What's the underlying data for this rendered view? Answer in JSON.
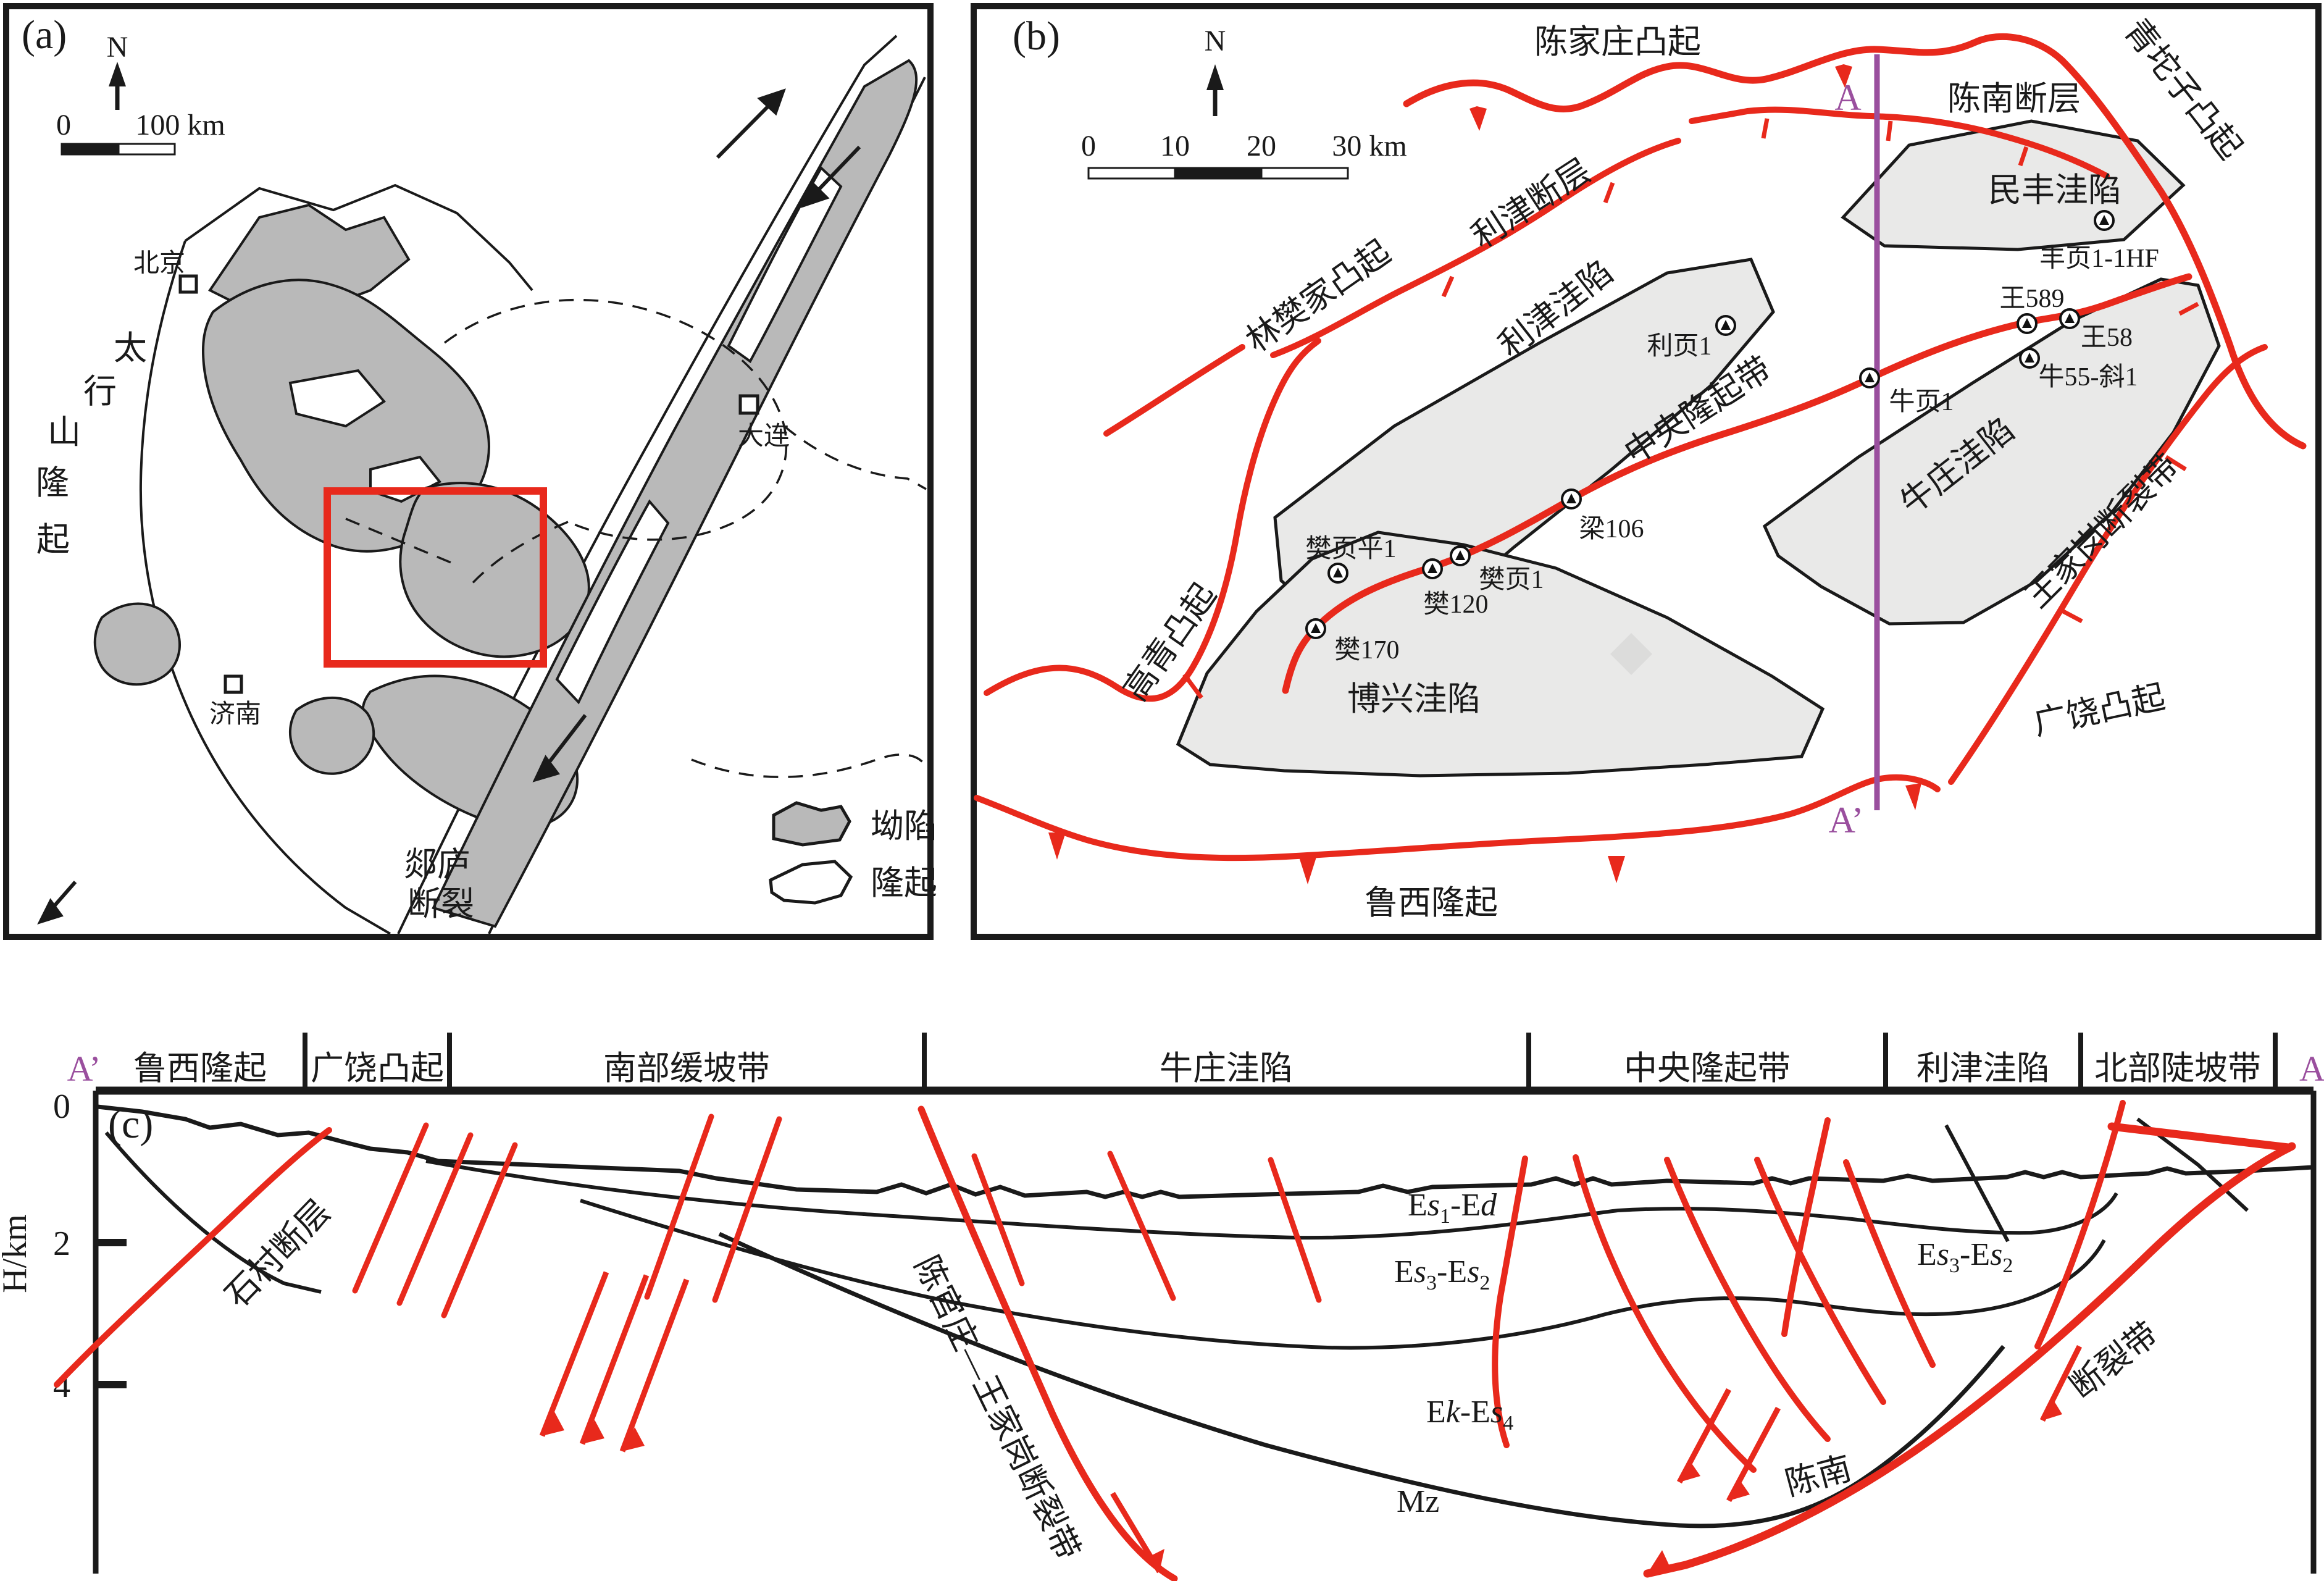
{
  "colors": {
    "fault_red": "#e8291c",
    "section_line_purple": "#9a4f9e",
    "regional_depression_gray": "#b9b9b9",
    "detail_depression_gray": "#e9e9e8"
  },
  "panel_a": {
    "tag": "(a)",
    "north": "N",
    "scale": {
      "zero": "0",
      "end": "100 km"
    },
    "cities": {
      "beijing": "北京",
      "jinan": "济南",
      "dalian": "大连"
    },
    "taihang": [
      "太",
      "行",
      "山",
      "隆",
      "起"
    ],
    "tanlu": [
      "郯庐",
      "断裂"
    ],
    "legend": {
      "depression": "坳陷",
      "uplift": "隆起"
    }
  },
  "panel_b": {
    "tag": "(b)",
    "north": "N",
    "scale": {
      "t0": "0",
      "t10": "10",
      "t20": "20",
      "t30": "30 km"
    },
    "labels": {
      "chenjiazhuang": "陈家庄凸起",
      "chennan_fault": "陈南断层",
      "qingtuozi": "青坨子凸起",
      "mifeng": "民丰洼陷",
      "lijin_fault": "利津断层",
      "linfanjia": "林樊家凸起",
      "lijin_sag": "利津洼陷",
      "central_uplift": "中央隆起带",
      "niuzhuang": "牛庄洼陷",
      "wangjiagang": "王家岗断裂带",
      "gaoqing": "高青凸起",
      "boxing": "博兴洼陷",
      "guangrao": "广饶凸起",
      "luxi": "鲁西隆起"
    },
    "wells": {
      "fengye": "丰页1-1HF",
      "wang589": "王589",
      "wang58": "王58",
      "niu55": "牛55-斜1",
      "niuye1": "牛页1",
      "liye1": "利页1",
      "liang106": "梁106",
      "fanyeping1": "樊页平1",
      "fanye1": "樊页1",
      "fan120": "樊120",
      "fan170": "樊170"
    },
    "section": {
      "a": "A",
      "a_prime": "A’"
    }
  },
  "panel_c": {
    "tag": "(c)",
    "a_prime": "A’",
    "a": "A",
    "zones": [
      "鲁西隆起",
      "广饶凸起",
      "南部缓坡带",
      "牛庄洼陷",
      "中央隆起带",
      "利津洼陷",
      "北部陡坡带"
    ],
    "axis": {
      "label": "H/km",
      "t0": "0",
      "t2": "2",
      "t4": "4"
    },
    "fault_labels": {
      "shicun": "石村断层",
      "chenguan": "陈官庄—王家岗断裂带",
      "chennan": "陈南",
      "duanliedai": "断裂带"
    },
    "strata": {
      "es1ed": {
        "e": "E",
        "s": "s",
        "sub": "1",
        "dash_e": "-E",
        "d": "d"
      },
      "es3es2": {
        "e": "E",
        "s": "s",
        "sub1": "3",
        "dash_e": "-E",
        "s2": "s",
        "sub2": "2"
      },
      "ekes4": {
        "e": "E",
        "k": "k",
        "dash_e": "-E",
        "s": "s",
        "sub": "4"
      },
      "mz": "Mz"
    }
  }
}
